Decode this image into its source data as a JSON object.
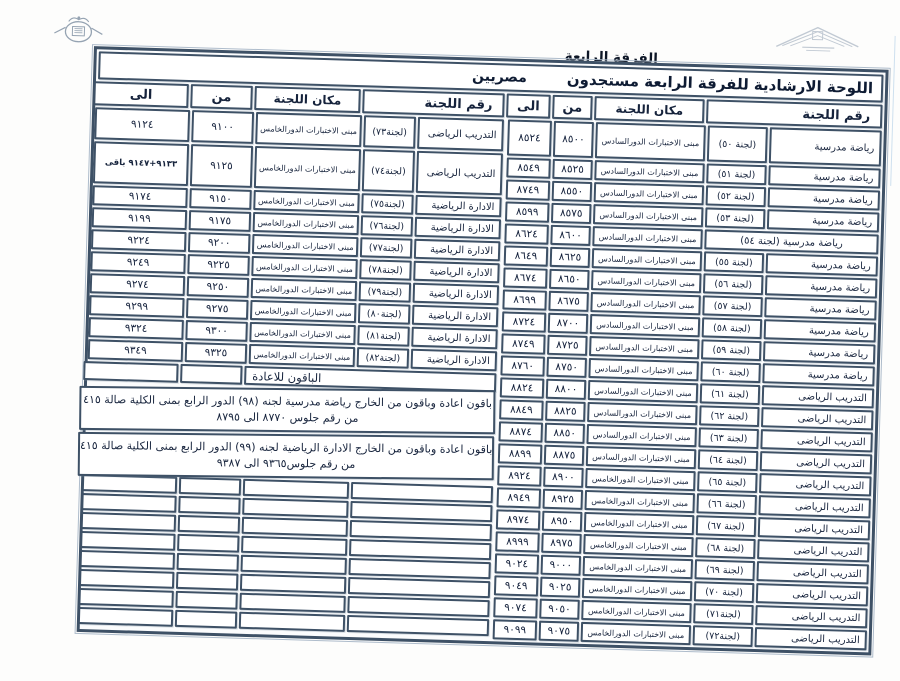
{
  "page": {
    "corner_label": "الفرقة الرابعة",
    "title": "اللوحة الارشادية للفرقة الرابعة مستجدون",
    "nationality_label": "مصريين"
  },
  "headers": {
    "committee": "رقم اللجنة",
    "location": "مكان اللجنة",
    "from": "من",
    "to": "الى"
  },
  "right_table": {
    "rows": [
      {
        "committee": "رياضة مدرسية",
        "number": "(لجنة ٥٠)",
        "location": "مبنى الاختبارات الدورالسادس",
        "from": "٨٥٠٠",
        "to": "٨٥٢٤"
      },
      {
        "committee": "رياضة مدرسية",
        "number": "(لجنة ٥١)",
        "location": "مبنى الاختبارات الدورالسادس",
        "from": "٨٥٢٥",
        "to": "٨٥٤٩"
      },
      {
        "committee": "رياضة مدرسية",
        "number": "(لجنة ٥٢)",
        "location": "مبنى الاختبارات الدورالسادس",
        "from": "٨٥٥٠",
        "to": "٨٧٤٩"
      },
      {
        "committee": "رياضة مدرسية",
        "number": "(لجنة ٥٣)",
        "location": "مبنى الاختبارات الدورالسادس",
        "from": "٨٥٧٥",
        "to": "٨٥٩٩"
      },
      {
        "merged": "رياضة مدرسية (لجنة ٥٤)",
        "location": "مبنى الاختبارات الدورالسادس",
        "from": "٨٦٠٠",
        "to": "٨٦٢٤"
      },
      {
        "committee": "رياضة مدرسية",
        "number": "(لجنة ٥٥)",
        "location": "مبنى الاختبارات الدورالسادس",
        "from": "٨٦٢٥",
        "to": "٨٦٤٩"
      },
      {
        "committee": "رياضة مدرسية",
        "number": "(لجنة ٥٦)",
        "location": "مبنى الاختبارات الدورالسادس",
        "from": "٨٦٥٠",
        "to": "٨٦٧٤"
      },
      {
        "committee": "رياضة مدرسية",
        "number": "(لجنة ٥٧)",
        "location": "مبنى الاختبارات الدورالسادس",
        "from": "٨٦٧٥",
        "to": "٨٦٩٩"
      },
      {
        "committee": "رياضة مدرسية",
        "number": "(لجنة ٥٨)",
        "location": "مبنى الاختبارات الدورالسادس",
        "from": "٨٧٠٠",
        "to": "٨٧٢٤"
      },
      {
        "committee": "رياضة مدرسية",
        "number": "(لجنة ٥٩)",
        "location": "مبنى الاختبارات الدورالسادس",
        "from": "٨٧٢٥",
        "to": "٨٧٤٩"
      },
      {
        "committee": "رياضة مدرسية",
        "number": "(لجنة ٦٠)",
        "location": "مبنى الاختبارات الدورالسادس",
        "from": "٨٧٥٠",
        "to": "٨٧٦٠"
      },
      {
        "committee": "التدريب الرياضى",
        "number": "(لجنة ٦١)",
        "location": "مبنى الاختبارات الدورالسادس",
        "from": "٨٨٠٠",
        "to": "٨٨٢٤"
      },
      {
        "committee": "التدريب الرياضى",
        "number": "(لجنة ٦٢)",
        "location": "مبنى الاختبارات الدورالسادس",
        "from": "٨٨٢٥",
        "to": "٨٨٤٩"
      },
      {
        "committee": "التدريب الرياضى",
        "number": "(لجنة ٦٣)",
        "location": "مبنى الاختبارات الدورالسادس",
        "from": "٨٨٥٠",
        "to": "٨٨٧٤"
      },
      {
        "committee": "التدريب الرياضى",
        "number": "(لجنة ٦٤)",
        "location": "مبنى الاختبارات الدورالسادس",
        "from": "٨٨٧٥",
        "to": "٨٨٩٩"
      },
      {
        "committee": "التدريب الرياضى",
        "number": "(لجنة ٦٥)",
        "location": "مبنى الاختبارات الدورالخامس",
        "from": "٨٩٠٠",
        "to": "٨٩٢٤"
      },
      {
        "committee": "التدريب الرياضى",
        "number": "(لجنة ٦٦)",
        "location": "مبنى الاختبارات الدورالخامس",
        "from": "٨٩٢٥",
        "to": "٨٩٤٩"
      },
      {
        "committee": "التدريب الرياضى",
        "number": "(لجنة ٦٧)",
        "location": "مبنى الاختبارات الدورالخامس",
        "from": "٨٩٥٠",
        "to": "٨٩٧٤"
      },
      {
        "committee": "التدريب الرياضى",
        "number": "(لجنة ٦٨)",
        "location": "مبنى الاختبارات الدورالخامس",
        "from": "٨٩٧٥",
        "to": "٨٩٩٩"
      },
      {
        "committee": "التدريب الرياضى",
        "number": "(لجنة ٦٩)",
        "location": "مبنى الاختبارات الدورالخامس",
        "from": "٩٠٠٠",
        "to": "٩٠٢٤"
      },
      {
        "committee": "التدريب الرياضى",
        "number": "(لجنة ٧٠)",
        "location": "مبنى الاختبارات الدورالخامس",
        "from": "٩٠٢٥",
        "to": "٩٠٤٩"
      },
      {
        "committee": "التدريب الرياضى",
        "number": "(لجنة٧١)",
        "location": "مبنى الاختبارات الدورالخامس",
        "from": "٩٠٥٠",
        "to": "٩٠٧٤"
      },
      {
        "committee": "التدريب الرياضى",
        "number": "(لجنة٧٢)",
        "location": "مبنى الاختبارات الدورالخامس",
        "from": "٩٠٧٥",
        "to": "٩٠٩٩"
      }
    ]
  },
  "left_table": {
    "rows": [
      {
        "committee": "التدريب الرياضى",
        "number": "(لجنة٧٣)",
        "location": "مبنى الاختبارات الدورالخامس",
        "from": "٩١٠٠",
        "to": "٩١٢٤"
      },
      {
        "committee": "التدريب الرياضى",
        "number": "(لجنة٧٤)",
        "location": "مبنى الاختبارات الدورالخامس",
        "from": "٩١٢٥",
        "to": "٩١٣٣+٩١٤٧ باقى"
      },
      {
        "committee": "الادارة الرياضية",
        "number": "(لجنة٧٥)",
        "location": "مبنى الاختبارات الدورالخامس",
        "from": "٩١٥٠",
        "to": "٩١٧٤"
      },
      {
        "committee": "الادارة الرياضية",
        "number": "(لجنة٧٦)",
        "location": "مبنى الاختبارات الدورالخامس",
        "from": "٩١٧٥",
        "to": "٩١٩٩"
      },
      {
        "committee": "الادارة الرياضية",
        "number": "(لجنة٧٧)",
        "location": "مبنى الاختبارات الدورالخامس",
        "from": "٩٢٠٠",
        "to": "٩٢٢٤"
      },
      {
        "committee": "الادارة الرياضية",
        "number": "(لجنة٧٨)",
        "location": "مبنى الاختبارات الدورالخامس",
        "from": "٩٢٢٥",
        "to": "٩٢٤٩"
      },
      {
        "committee": "الادارة الرياضية",
        "number": "(لجنة٧٩)",
        "location": "مبنى الاختبارات الدورالخامس",
        "from": "٩٢٥٠",
        "to": "٩٢٧٤"
      },
      {
        "committee": "الادارة الرياضية",
        "number": "(لجنة٨٠)",
        "location": "مبنى الاختبارات الدورالخامس",
        "from": "٩٢٧٥",
        "to": "٩٢٩٩"
      },
      {
        "committee": "الادارة الرياضية",
        "number": "(لجنة٨١)",
        "location": "مبنى الاختبارات الدورالخامس",
        "from": "٩٣٠٠",
        "to": "٩٣٢٤"
      },
      {
        "committee": "الادارة الرياضية",
        "number": "(لجنة٨٢)",
        "location": "مبنى الاختبارات الدورالخامس",
        "from": "٩٣٢٥",
        "to": "٩٣٤٩"
      }
    ],
    "remaining_label": "الباقون للاعادة",
    "notes": [
      {
        "line1": "باقون اعادة  وباقون من الخارج  رياضة مدرسية لجنه (٩٨) الدور الرابع بمنى الكلية صالة ٤١٥",
        "line2": "من رقم جلوس  ٨٧٧٠ الى ٨٧٩٥"
      },
      {
        "line1": "باقون اعادة  وباقون من الخارج  الادارة الرياضية  لجنه (٩٩) الدور الرابع بمنى الكلية صالة ٤١٥",
        "line2": "من رقم جلوس٩٣٦٥  الى ٩٣٨٧"
      }
    ],
    "empty_rows": 8
  }
}
